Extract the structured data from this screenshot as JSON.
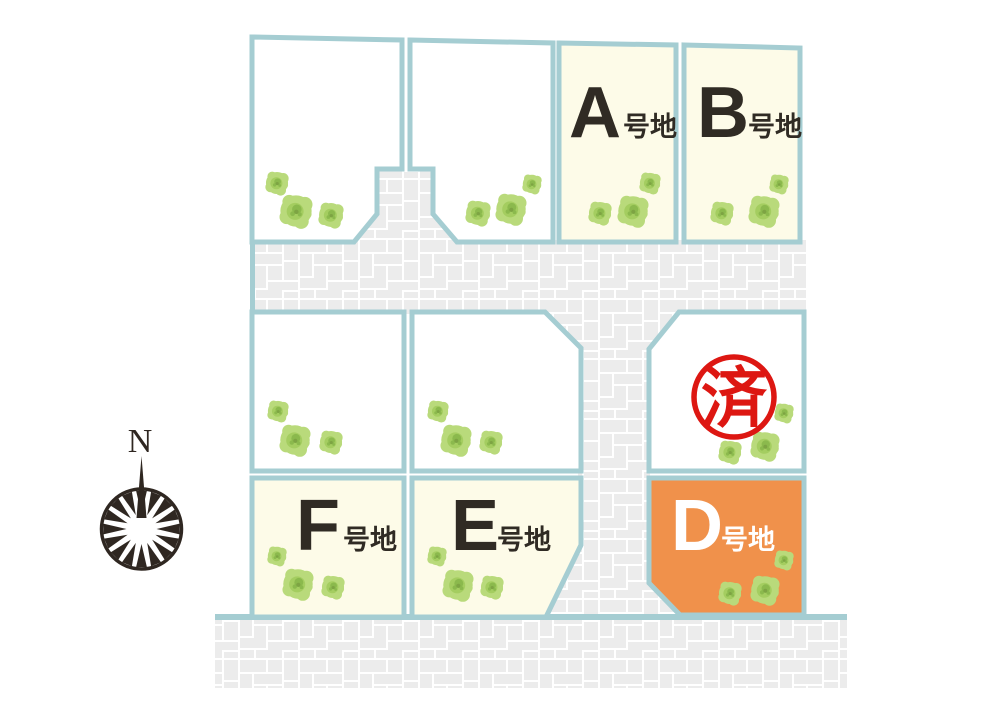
{
  "colors": {
    "page-bg": "#ffffff",
    "lot-border": "#a5cdd2",
    "lot-white": "#ffffff",
    "lot-cream": "#fdfbe8",
    "lot-orange": "#f0914b",
    "road-grout": "#ffffff",
    "road-brick": "#ececec",
    "tree-light": "#b9da7b",
    "tree-mid": "#a4cd60",
    "tree-dark": "#8bb94d",
    "tree-core": "#7da443",
    "label-dark": "#302b24",
    "label-light": "#ffffff",
    "stamp-red": "#dd1712",
    "compass-dark": "#2f2721"
  },
  "compass": {
    "label": "N"
  },
  "stamp": {
    "text": "済"
  },
  "plots": {
    "a": {
      "letter": "A",
      "suffix": "号地"
    },
    "b": {
      "letter": "B",
      "suffix": "号地"
    },
    "d": {
      "letter": "D",
      "suffix": "号地"
    },
    "e": {
      "letter": "E",
      "suffix": "号地"
    },
    "f": {
      "letter": "F",
      "suffix": "号地"
    }
  }
}
